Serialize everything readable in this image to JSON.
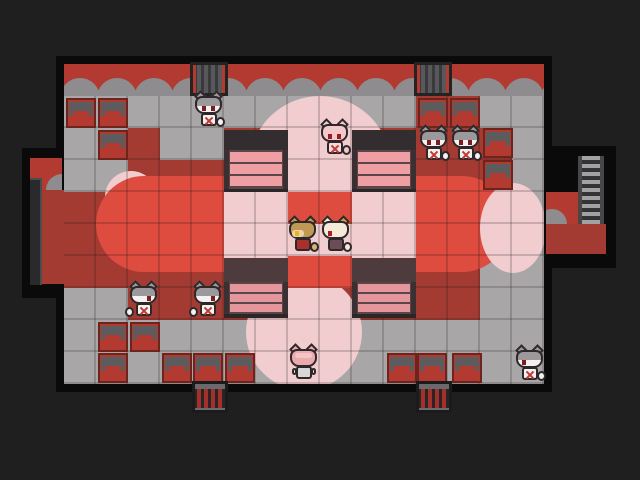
{
  "scene": {
    "width": 640,
    "height": 480,
    "tile": 32
  },
  "palette": {
    "bg": "#1f1f1f",
    "outline": "#0a0a0a",
    "wall_red": "#b23a31",
    "scallop_gray": "#8e8c8e",
    "floor_gray": "#a9a6a7",
    "carpet_dark": "#a43b33",
    "carpet_bright": "#dd4c3e",
    "light_pink": "#f1cdcf",
    "glass_pink": "#ef9fa4",
    "glass_pink_low": "#e5969c",
    "shelf_dark": "#332d2f",
    "shelf_frame": "#5a4648",
    "shelf_low_top": "#4d3b3d",
    "shelf_base": "#2c2628",
    "chair_red": "#b23a31",
    "cage_bar": "#58585c",
    "gate_bar": "#a23129",
    "gate_top": "#6a6a6e",
    "strip_dark": "#2a2a2c",
    "strip_edge": "#4c4c4e",
    "cat_gray": "#9b999c",
    "cat_white": "#f3f1f1",
    "eye_dark": "#7c1e1e",
    "mark_red": "#c23b33",
    "pinkcat_head": "#f3c9cb",
    "pinkcat_body": "#f7dbdd",
    "fox_hair": "#c09a55",
    "fox_face": "#eed2a6",
    "fox_eye": "#e5b71e",
    "fox_dress": "#a83028",
    "fox_tail": "#d9b375",
    "cream": "#f5e9d8",
    "cream_ear": "#cfa23f",
    "cream_eye": "#ad1f1f",
    "cloak": "#6b4d55",
    "back_head": "#eaabae",
    "back_head_hi": "#f4c5c7",
    "back_body": "#d9d6d7"
  },
  "room": {
    "plates": [
      [
        56,
        56,
        496,
        336
      ],
      [
        22,
        148,
        48,
        150
      ],
      [
        538,
        146,
        78,
        122
      ]
    ],
    "wall": {
      "x": 64,
      "y": 64,
      "w": 480,
      "h": 32,
      "scallop_step": 37,
      "scallop_r": 20,
      "scallop_count": 14
    },
    "floor": {
      "x": 64,
      "y": 96,
      "w": 480,
      "h": 288
    },
    "carpet_dark": [
      [
        128,
        128,
        288,
        192
      ],
      [
        64,
        192,
        64,
        96
      ],
      [
        416,
        96,
        64,
        224
      ],
      [
        480,
        128,
        32,
        64
      ]
    ],
    "gray_patches": [
      [
        160,
        128,
        64,
        32
      ]
    ],
    "pink_under_corner": [
      105,
      171,
      52,
      52
    ],
    "carpet_bright": [
      96,
      176,
      414,
      96
    ],
    "pink_shapes": [
      {
        "shape": "circle",
        "x": 249,
        "y": 96,
        "w": 142,
        "h": 142
      },
      {
        "shape": "rect",
        "x": 224,
        "y": 192,
        "w": 192,
        "h": 96
      },
      {
        "shape": "circle",
        "x": 246,
        "y": 274,
        "w": 116,
        "h": 116
      },
      {
        "shape": "ellipse",
        "x": 480,
        "y": 183,
        "w": 66,
        "h": 90
      }
    ],
    "red_blocks": [
      [
        288,
        192,
        64,
        32
      ],
      [
        288,
        256,
        64,
        32
      ]
    ],
    "alcove_left": {
      "wall": [
        30,
        158,
        32,
        32
      ],
      "mound": [
        46,
        174,
        32,
        32
      ],
      "strip": [
        30,
        178,
        12,
        107
      ],
      "floor": [
        42,
        190,
        24,
        94
      ]
    },
    "alcove_right": {
      "wall": [
        546,
        192,
        32,
        32
      ],
      "mound": [
        537,
        209,
        30,
        30
      ],
      "floor": [
        546,
        224,
        60,
        30
      ],
      "ladder": [
        578,
        156,
        26,
        68
      ]
    }
  },
  "furniture": {
    "chairs": [
      [
        66,
        98
      ],
      [
        98,
        98
      ],
      [
        98,
        130
      ],
      [
        418,
        98
      ],
      [
        450,
        98
      ],
      [
        483,
        128
      ],
      [
        483,
        160
      ],
      [
        98,
        322
      ],
      [
        130,
        322
      ],
      [
        98,
        353
      ],
      [
        162,
        353
      ],
      [
        193,
        353
      ],
      [
        225,
        353
      ],
      [
        387,
        353
      ],
      [
        417,
        353
      ],
      [
        452,
        353
      ]
    ],
    "shelves": [
      [
        224,
        130,
        "upper"
      ],
      [
        352,
        130,
        "upper"
      ],
      [
        224,
        258,
        "lower"
      ],
      [
        352,
        258,
        "lower"
      ]
    ],
    "cages": [
      [
        190,
        62
      ],
      [
        414,
        62
      ]
    ],
    "gates": [
      [
        192,
        381
      ],
      [
        416,
        381
      ]
    ]
  },
  "characters": [
    {
      "id": "cat-1",
      "type": "gray",
      "x": 194,
      "y": 91,
      "facing": "down"
    },
    {
      "id": "cat-2",
      "type": "pink",
      "x": 320,
      "y": 119,
      "facing": "down"
    },
    {
      "id": "cat-3",
      "type": "gray",
      "x": 419,
      "y": 125,
      "facing": "down"
    },
    {
      "id": "cat-4",
      "type": "gray",
      "x": 451,
      "y": 125,
      "facing": "down"
    },
    {
      "id": "fox-girl",
      "type": "fox",
      "x": 288,
      "y": 216,
      "facing": "left"
    },
    {
      "id": "cream-cat",
      "type": "cream",
      "x": 321,
      "y": 216,
      "facing": "left"
    },
    {
      "id": "cat-5",
      "type": "gray",
      "x": 129,
      "y": 281,
      "facing": "right"
    },
    {
      "id": "cat-6",
      "type": "gray",
      "x": 193,
      "y": 281,
      "facing": "right"
    },
    {
      "id": "cat-7",
      "type": "back",
      "x": 289,
      "y": 344,
      "facing": "up"
    },
    {
      "id": "cat-8",
      "type": "gray",
      "x": 515,
      "y": 345,
      "facing": "left"
    }
  ]
}
